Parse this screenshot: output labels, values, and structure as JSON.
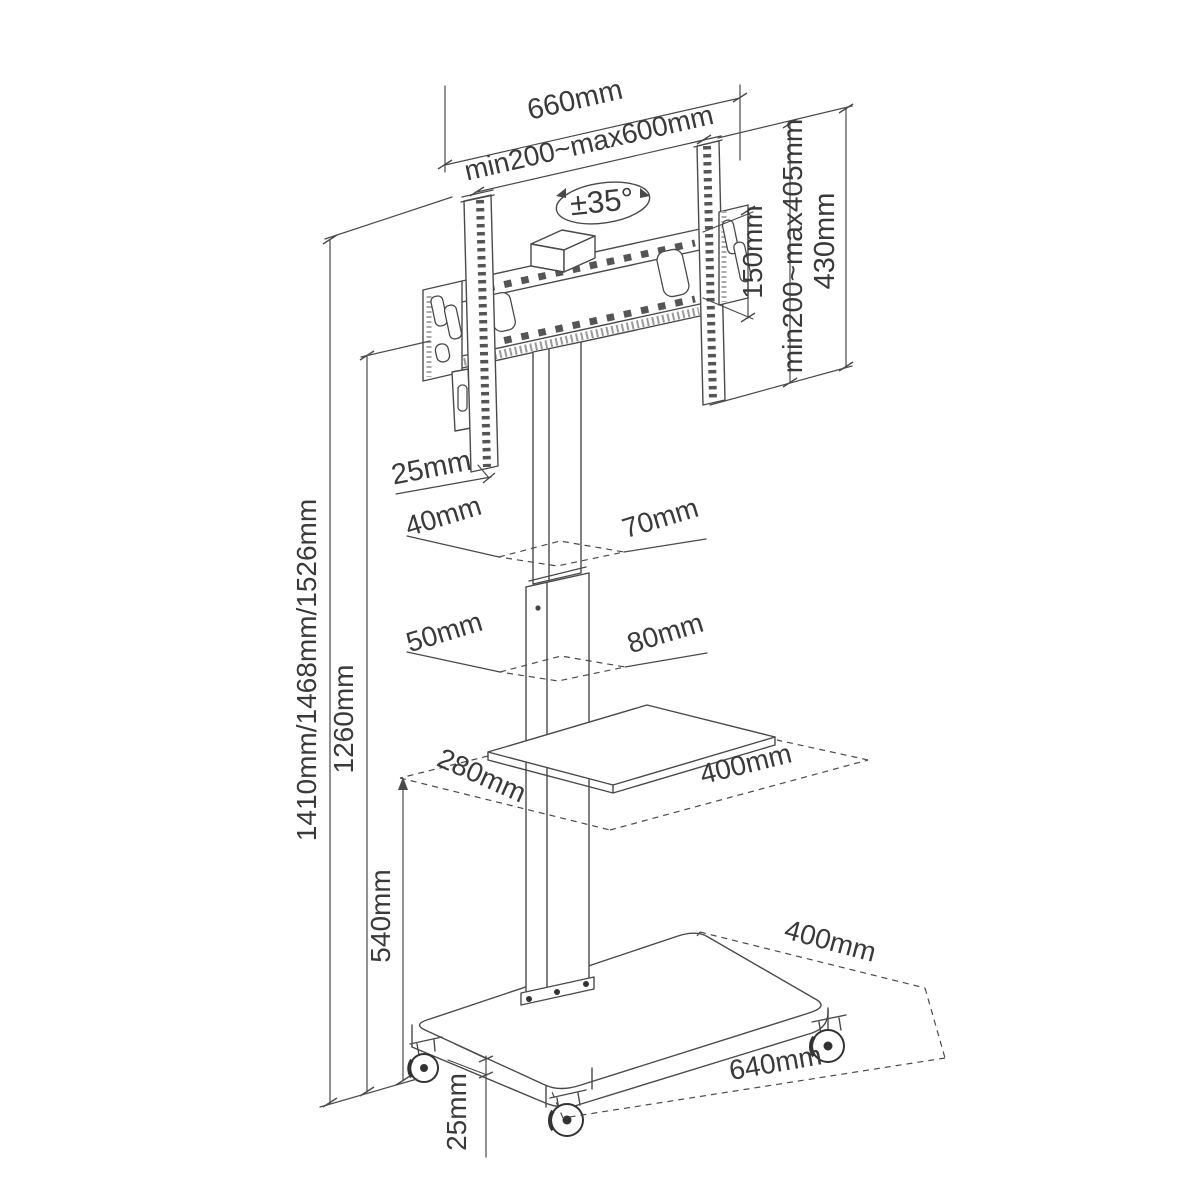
{
  "colors": {
    "background": "#ffffff",
    "line": "#4a4a4a",
    "text": "#3a3a3a"
  },
  "bracket": {
    "width": "660mm",
    "vesa_width_range": "min200~max600mm",
    "swivel_angle": "±35°",
    "plate_height": "150mm",
    "vesa_height_range": "min200~max405mm",
    "rail_height": "430mm",
    "rail_thickness": "25mm"
  },
  "pole": {
    "upper_depth": "40mm",
    "upper_width": "70mm",
    "lower_depth": "50mm",
    "lower_width": "80mm"
  },
  "shelf": {
    "depth": "280mm",
    "width": "400mm"
  },
  "heights": {
    "overall": "1410mm/1468mm/1526mm",
    "column": "1260mm",
    "shelf": "540mm"
  },
  "base": {
    "depth": "400mm",
    "width": "640mm",
    "thickness": "25mm"
  }
}
